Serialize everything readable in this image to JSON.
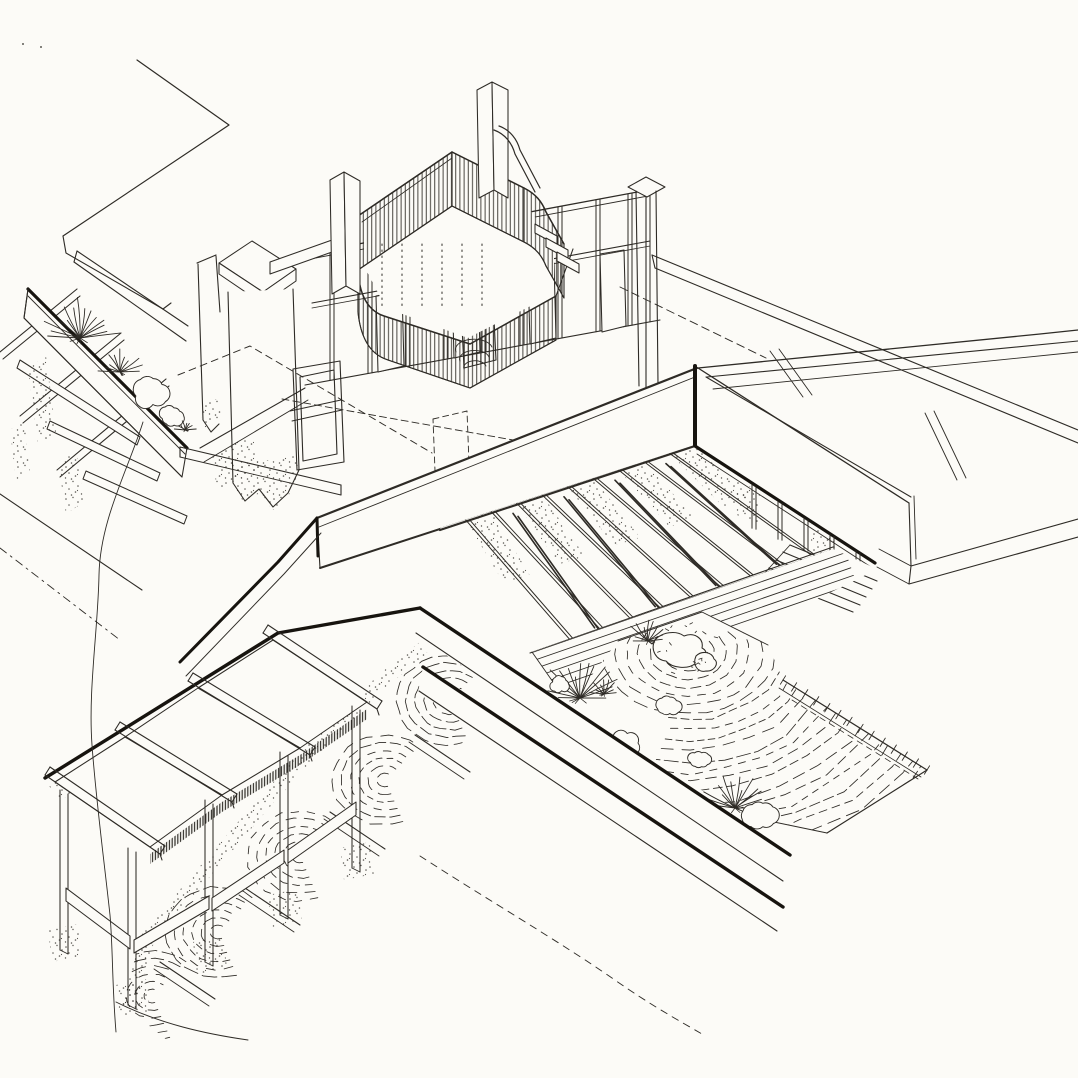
{
  "page": {
    "title": "Axonometric ink drawing — sunken courtyard house"
  },
  "figure": {
    "aria_label": "Hand-drawn black ink axonometric cutaway drawing of a house: a rooftop stair enclosure with vertical slat balustrades, tall angle posts, a planted terrace with agaves and shrubs, a chimney pier, a sunken courtyard with timber deck and steps, a raked gravel garden with boulders and plants, stepped pergola terraces over a rippled water cascade, and an adjacent flat-roofed building with parapet roof terrace.",
    "paper_color": "#fcfbf7",
    "ink_color": "#2e2b26",
    "heavy_ink_color": "#17140f",
    "medium": "ink line drawing",
    "textures": [
      "vertical-slat hatching",
      "stipple",
      "raked-gravel ripple arcs",
      "deck plank lines",
      "dashed hidden lines"
    ],
    "elements": [
      "roof canopy edge",
      "planter wall with agave and shrubs",
      "pergola beams and purlins",
      "chimney pier",
      "window frame",
      "stair enclosure with slatted balustrade",
      "stair railing and treads",
      "stud wall with openings",
      "tall angle posts",
      "flat-roofed building with parapet terrace",
      "sunken courtyard retaining walls",
      "timber deck",
      "courtyard steps",
      "zen gravel garden with boulders",
      "garden agaves and shrubs",
      "stepped pergola trellis",
      "water cascade ripples",
      "ground break lines"
    ]
  }
}
